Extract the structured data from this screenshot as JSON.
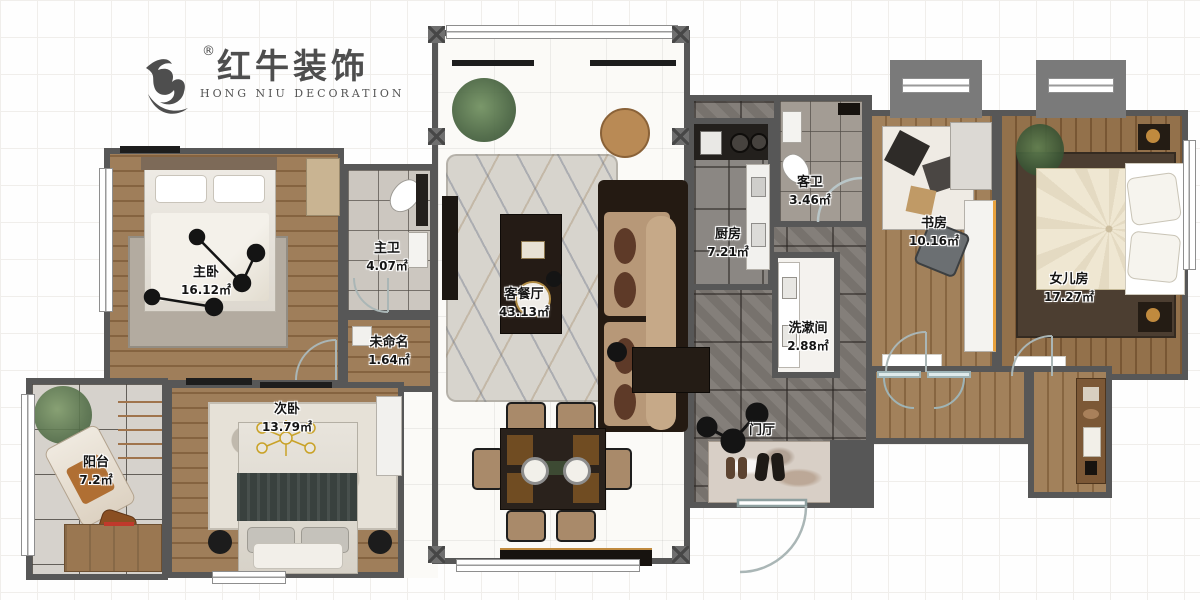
{
  "logo": {
    "brand": "红牛装饰",
    "reg": "®",
    "subtitle": "HONG NIU DECORATION"
  },
  "rooms": [
    {
      "name": "主卧",
      "area": "16.12㎡"
    },
    {
      "name": "主卫",
      "area": "4.07㎡"
    },
    {
      "name": "未命名",
      "area": "1.64㎡"
    },
    {
      "name": "次卧",
      "area": "13.79㎡"
    },
    {
      "name": "阳台",
      "area": "7.2㎡"
    },
    {
      "name": "客餐厅",
      "area": "43.13㎡"
    },
    {
      "name": "厨房",
      "area": "7.21㎡"
    },
    {
      "name": "客卫",
      "area": "3.46㎡"
    },
    {
      "name": "洗漱间",
      "area": "2.88㎡"
    },
    {
      "name": "书房",
      "area": "10.16㎡"
    },
    {
      "name": "女儿房",
      "area": "17.27㎡"
    },
    {
      "name": "门厅",
      "area": ""
    }
  ],
  "colors": {
    "wall": "#575757",
    "wood": "#9a7751",
    "hall_tile": "#7d7873",
    "accent_black": "#1d1d1d"
  }
}
